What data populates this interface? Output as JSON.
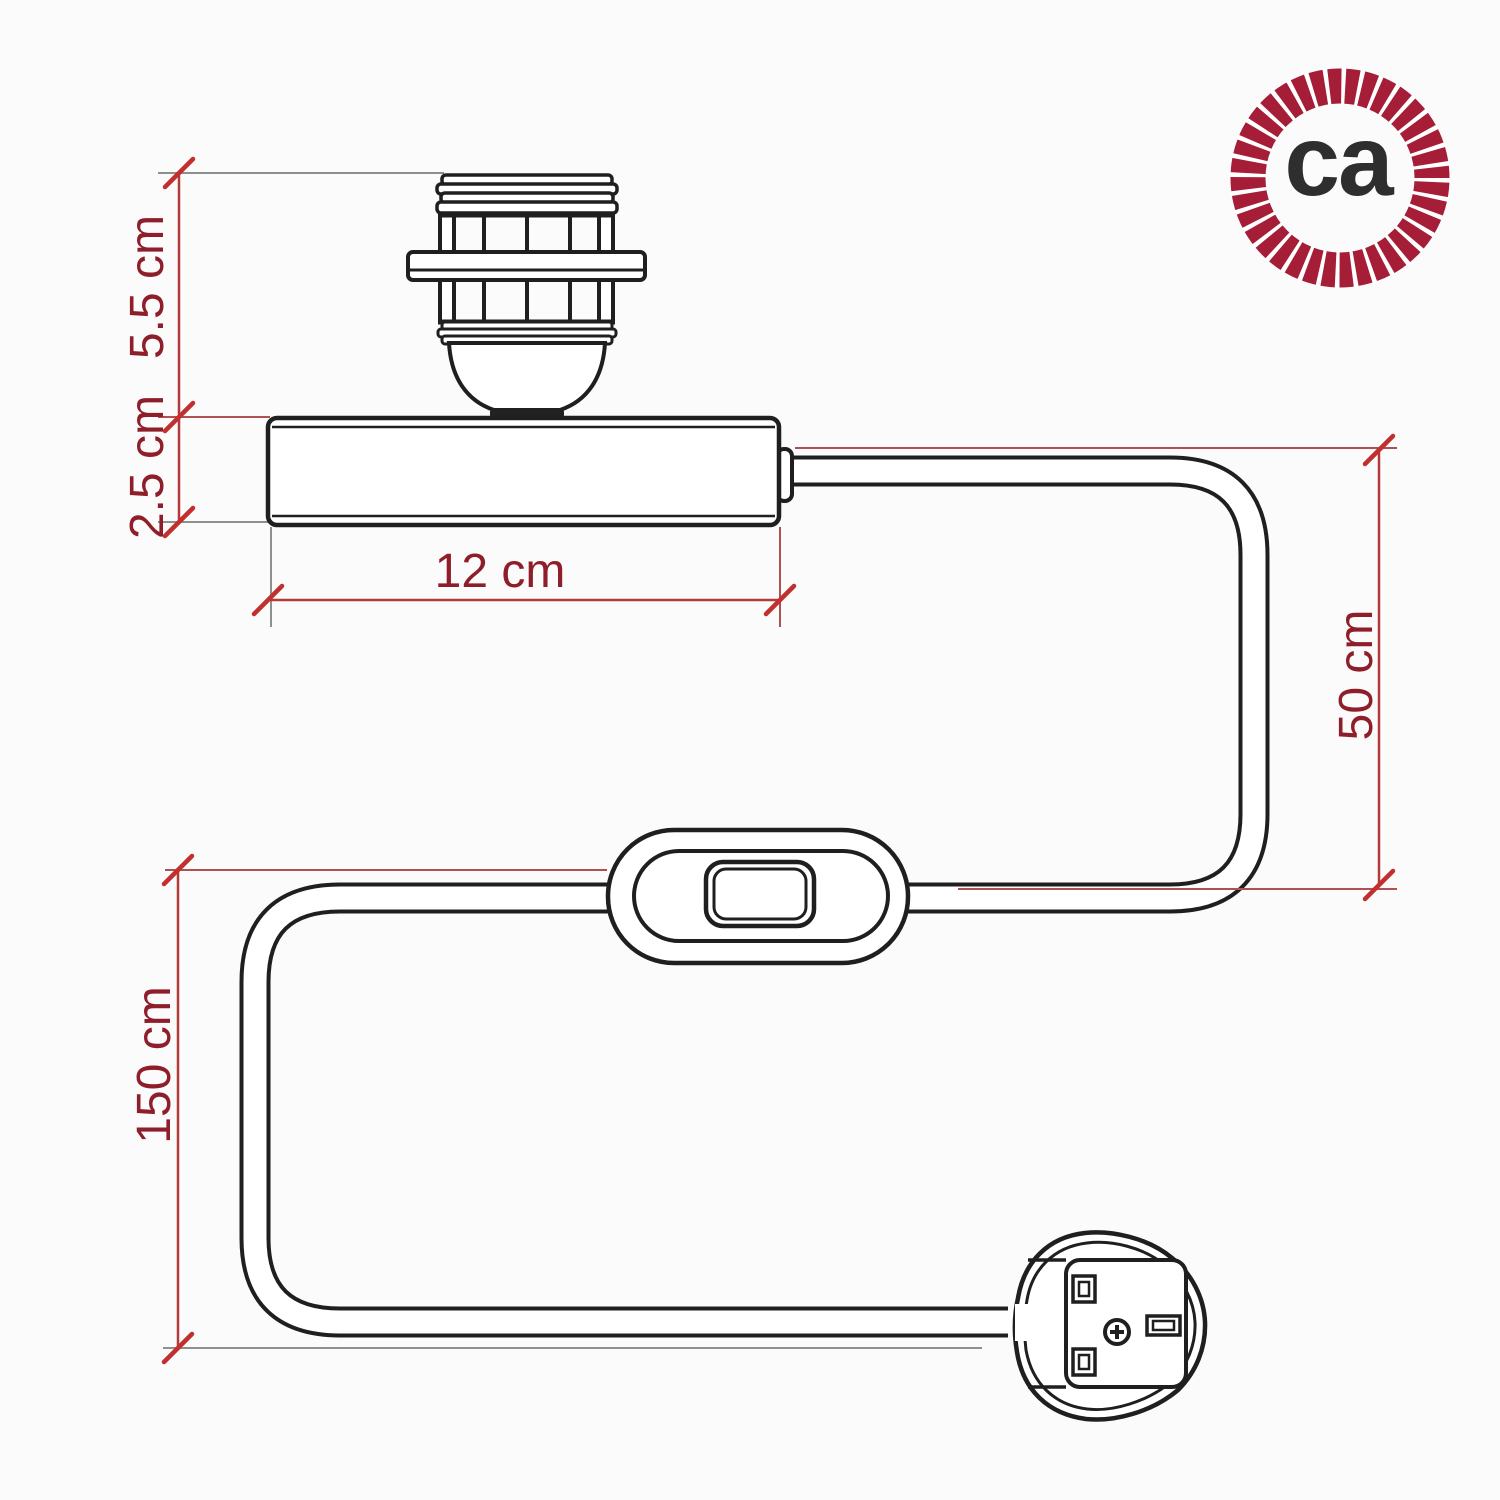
{
  "logo": {
    "text": "ca"
  },
  "dimensions": {
    "socket_height_label": "5.5 cm",
    "base_height_label": "2.5 cm",
    "base_width_label": "12 cm",
    "upper_cable_label": "50 cm",
    "lower_cable_label": "150 cm"
  },
  "colors": {
    "background": "#fbfbfb",
    "line_art": "#1f1f1f",
    "dimension_line": "#b23a3a",
    "tick": "#c22f2f",
    "dimension_text": "#8e1f2a",
    "extension_gray": "#8f8f8f",
    "extension_red": "#b05050",
    "logo_rope": "#a51d36",
    "logo_text": "#2e2e2e"
  }
}
